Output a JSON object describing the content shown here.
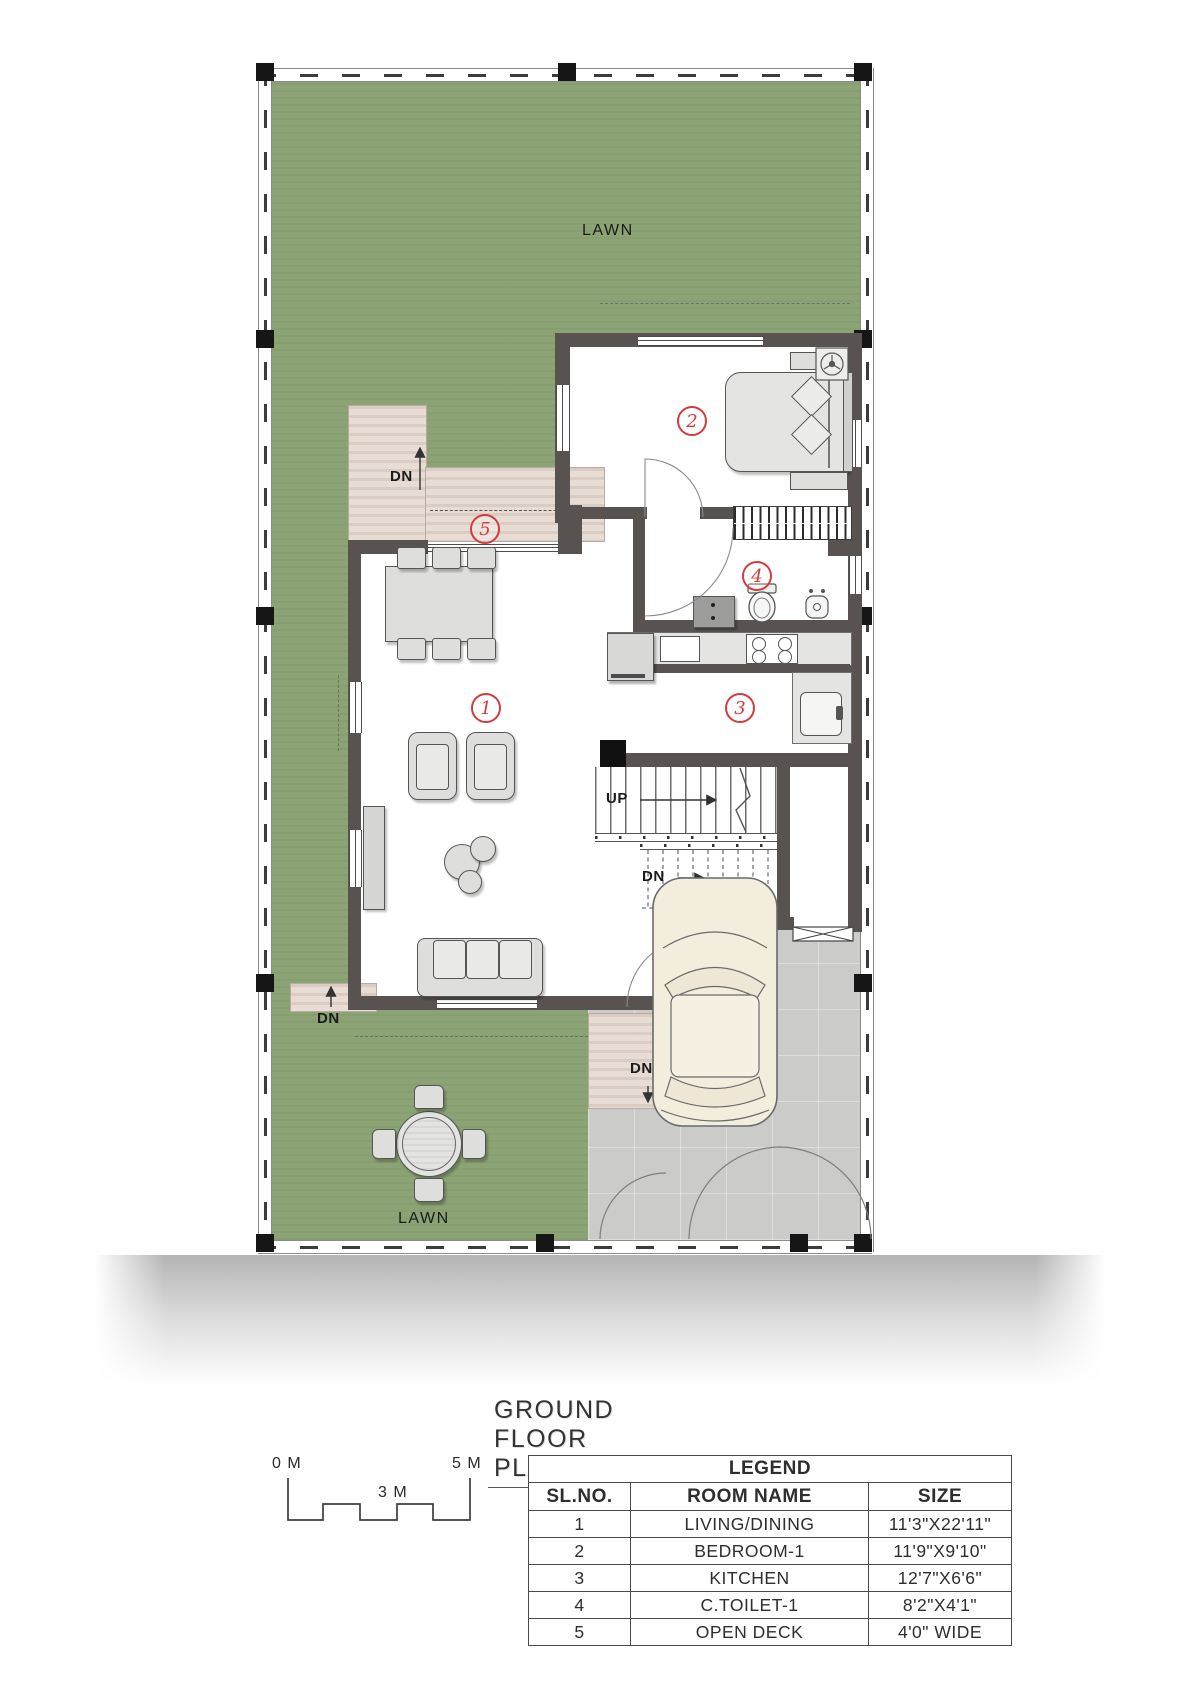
{
  "title": "GROUND FLOOR PLAN",
  "plan": {
    "labels": {
      "lawn_top": "LAWN",
      "lawn_bottom": "LAWN",
      "up": "UP",
      "dn": "DN"
    },
    "markers": [
      "1",
      "2",
      "3",
      "4",
      "5"
    ]
  },
  "scale_bar": {
    "zero": "0 M",
    "three": "3 M",
    "five": "5 M"
  },
  "legend": {
    "title": "LEGEND",
    "columns": [
      "SL.NO.",
      "ROOM NAME",
      "SIZE"
    ],
    "rows": [
      {
        "no": "1",
        "name": "LIVING/DINING",
        "size": "11'3\"X22'11\""
      },
      {
        "no": "2",
        "name": "BEDROOM-1",
        "size": "11'9\"X9'10\""
      },
      {
        "no": "3",
        "name": "KITCHEN",
        "size": "12'7\"X6'6\""
      },
      {
        "no": "4",
        "name": "C.TOILET-1",
        "size": "8'2\"X4'1\""
      },
      {
        "no": "5",
        "name": "OPEN DECK",
        "size": "4'0\" WIDE"
      }
    ]
  },
  "colors": {
    "lawn": "#8ca475",
    "wall": "#585351",
    "deck": "#e7ddd4",
    "drive": "#cbcbca",
    "marker": "#d23c3c",
    "car": "#f3edde"
  }
}
